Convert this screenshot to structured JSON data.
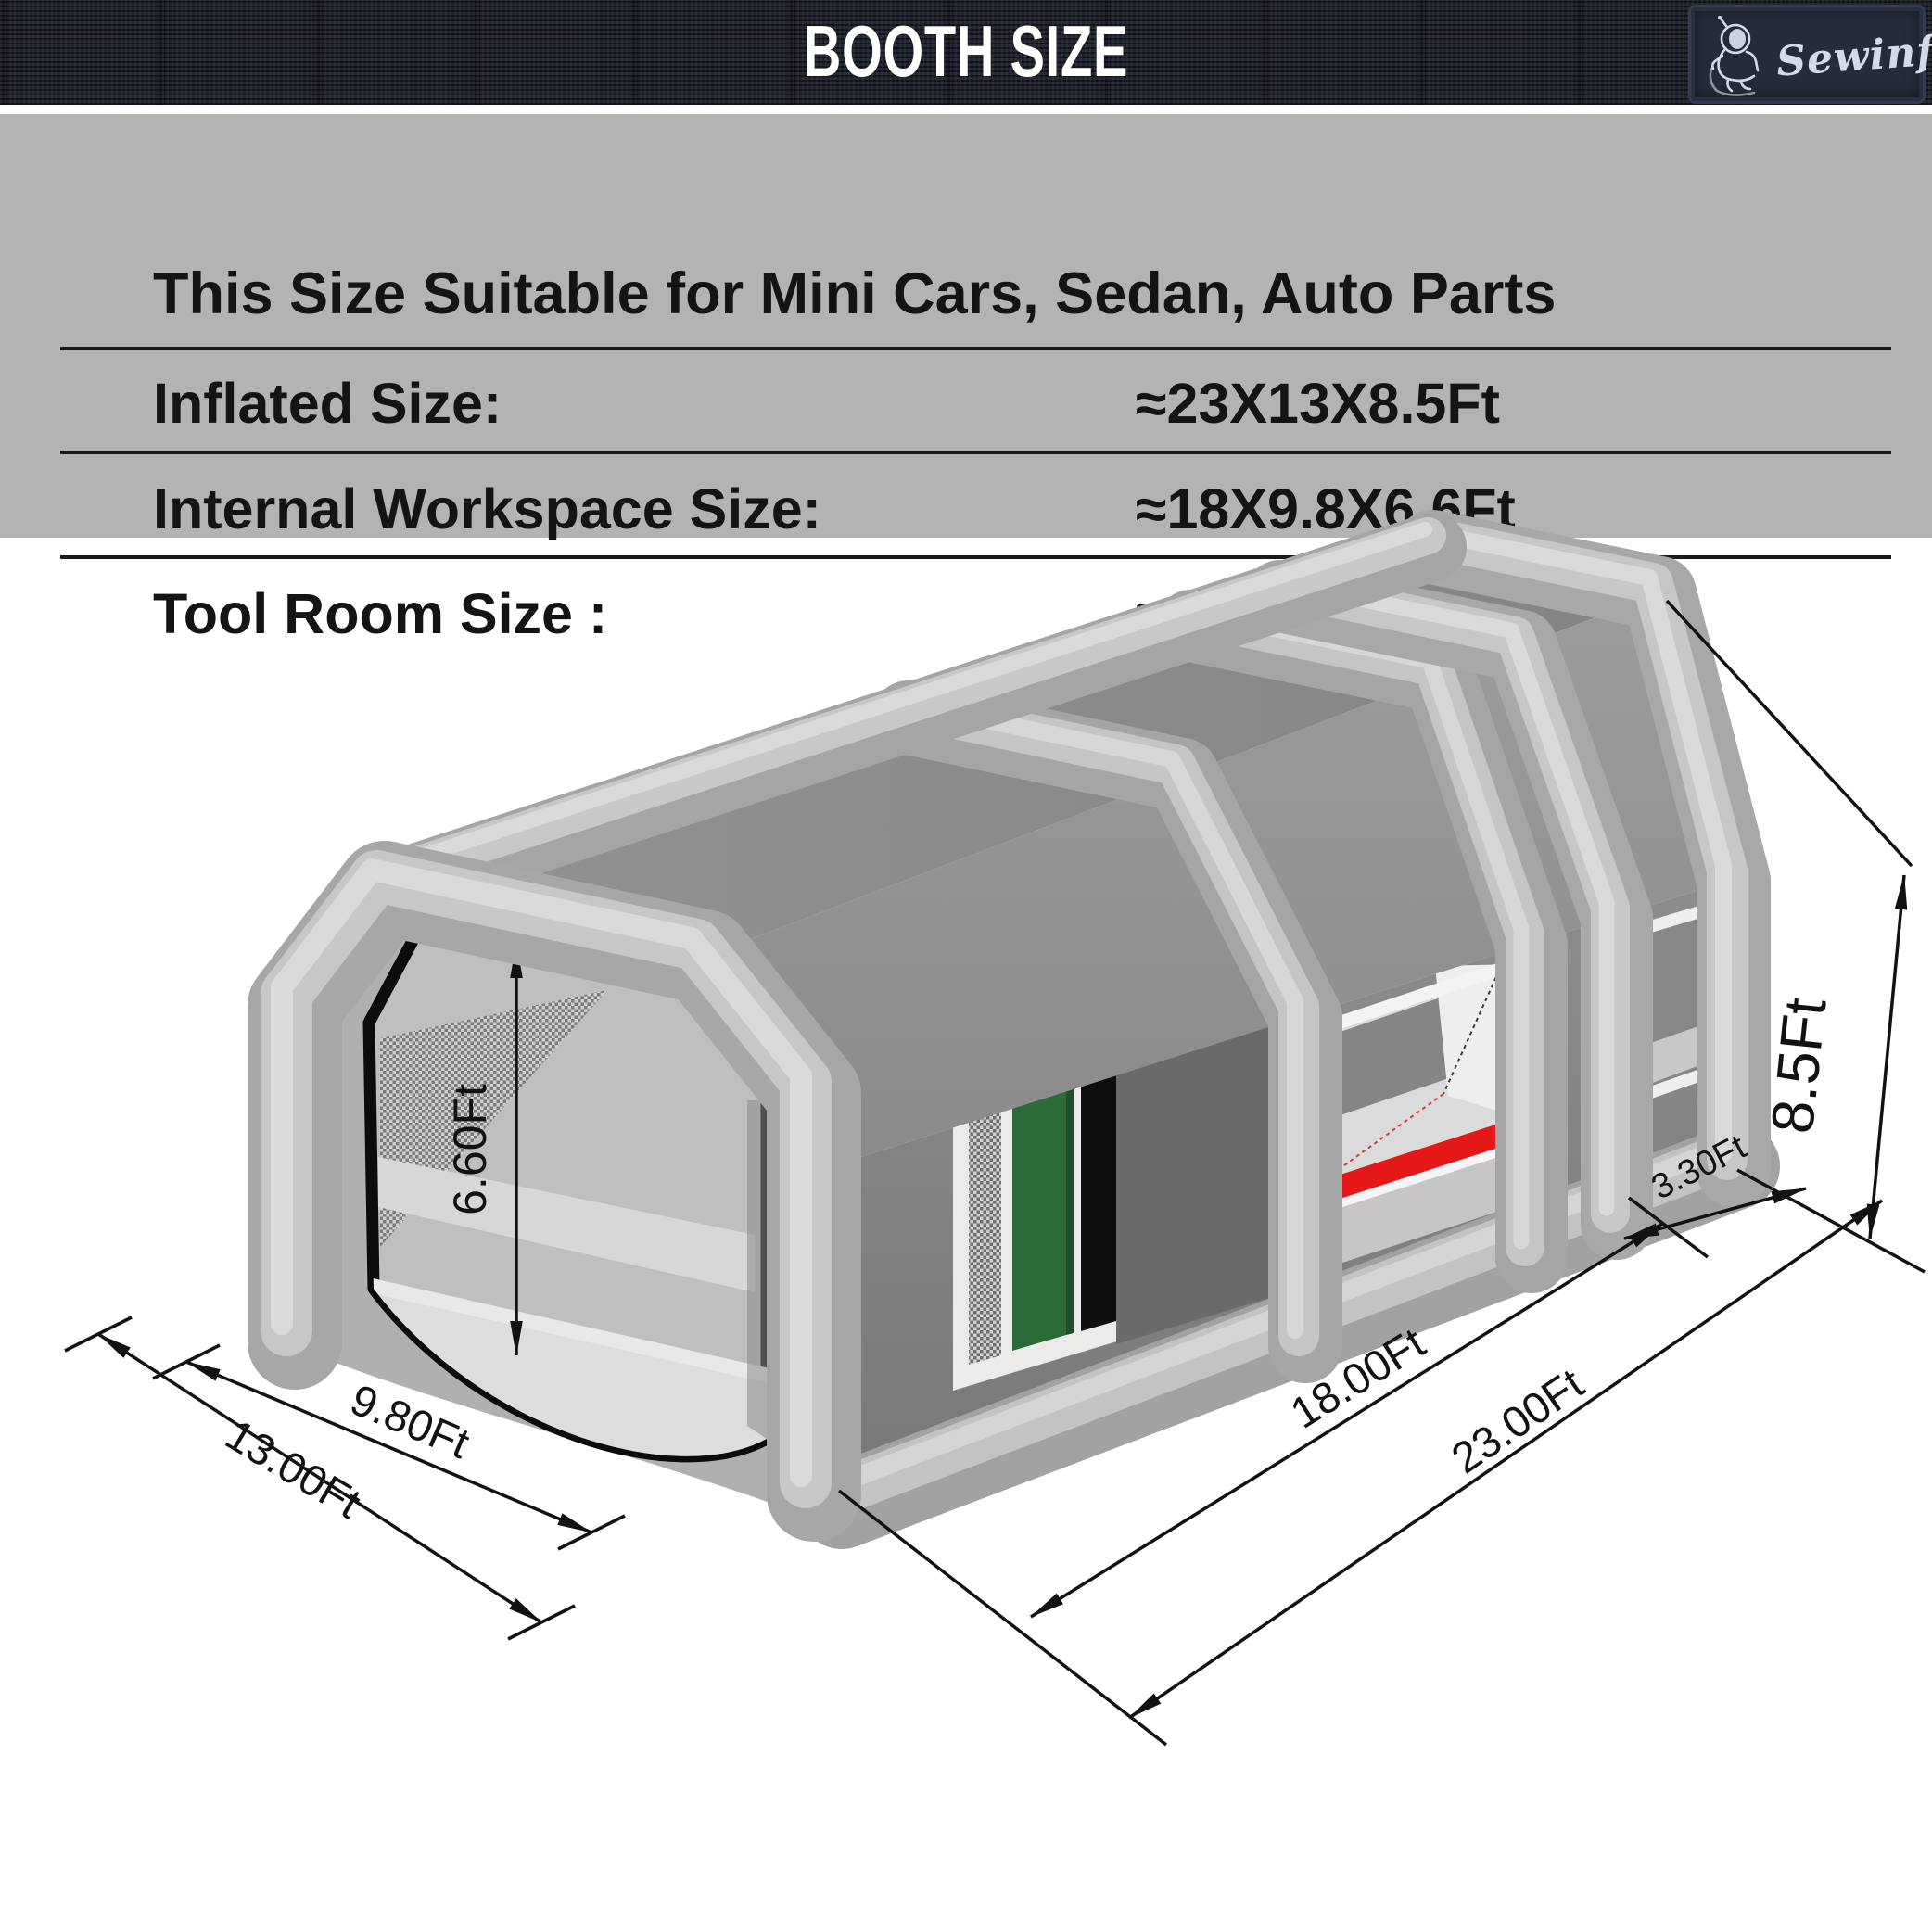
{
  "header": {
    "title": "BOOTH SIZE",
    "brand": "Sewinfla"
  },
  "spec_table": {
    "caption": "This Size Suitable for Mini Cars, Sedan, Auto Parts",
    "rows": [
      {
        "label": "Inflated Size:",
        "value": "≈23X13X8.5Ft"
      },
      {
        "label": "Internal Workspace Size:",
        "value": "≈18X9.8X6.6Ft"
      },
      {
        "label": "Tool Room Size :",
        "value": "≈3.3X9.8X6.6Ft"
      }
    ]
  },
  "diagram": {
    "dimensions": {
      "door_height": "6.60Ft",
      "front_inner_width": "9.80Ft",
      "front_outer_width": "13.00Ft",
      "workspace_length": "18.00Ft",
      "total_length": "23.00Ft",
      "tool_room_depth": "3.30Ft",
      "total_height": "8.5Ft"
    }
  },
  "colors": {
    "bar_bg": "#1b1f29",
    "band_bg": "#b4b2b2",
    "booth_gray": "#8d8c8c",
    "tube_gray": "#a6a5a5",
    "accent_red": "#e61717",
    "filter_green": "#2c6b38"
  }
}
